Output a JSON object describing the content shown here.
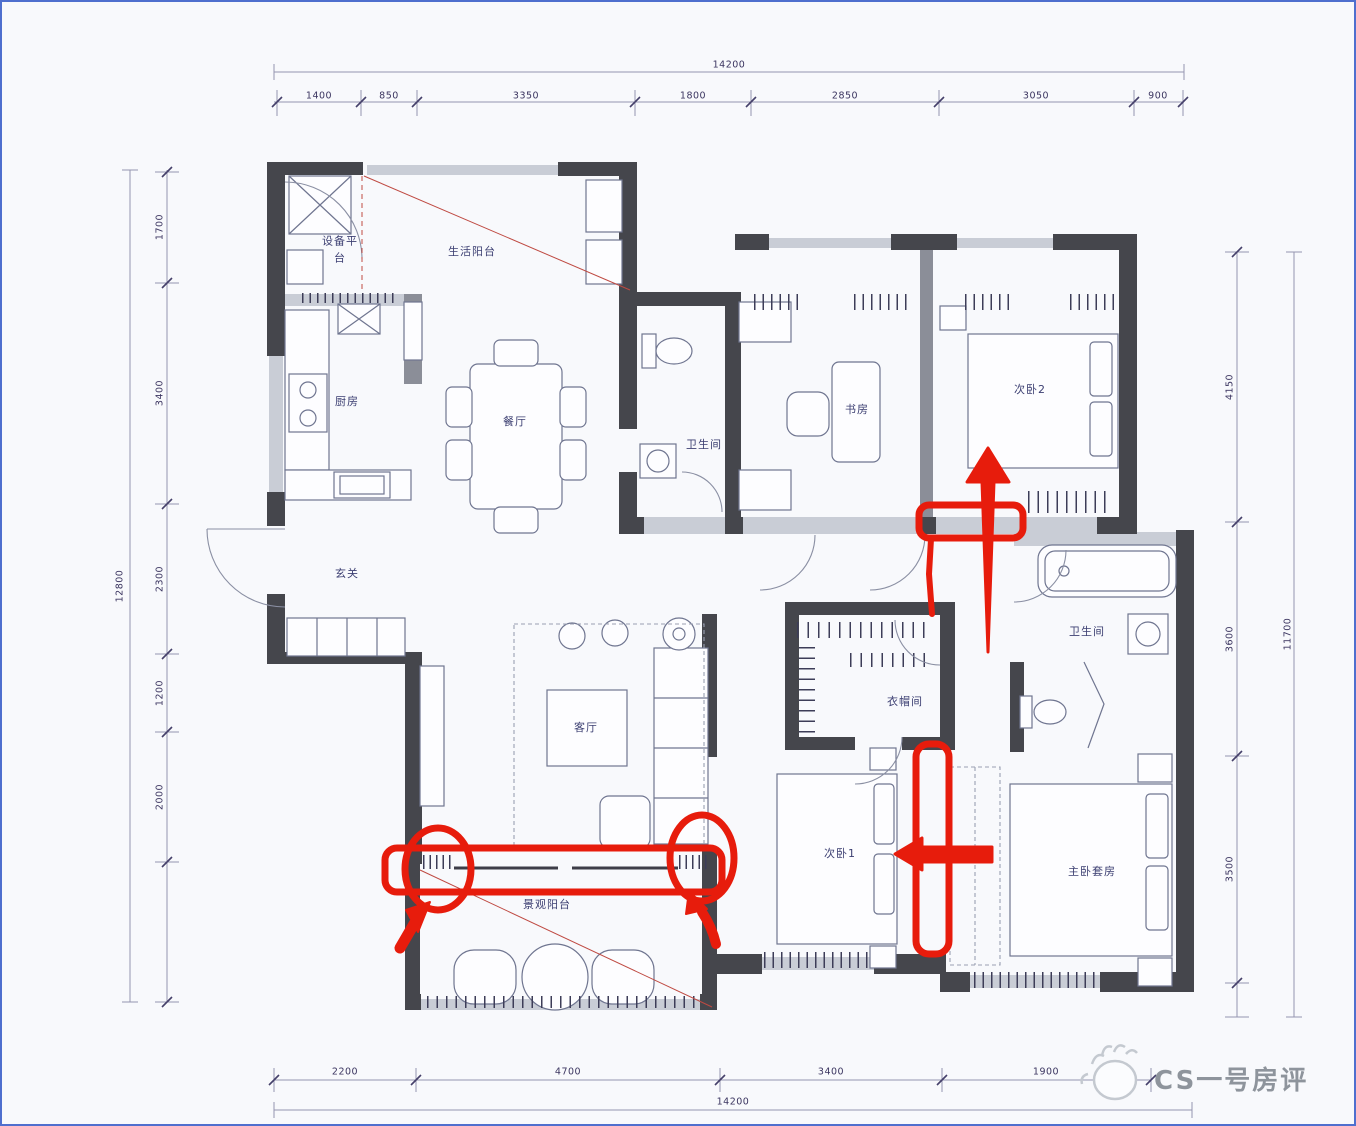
{
  "page": {
    "frame_color": "#4f6fce",
    "background": "#f8f9fc",
    "annotation_color": "#e71c0c",
    "wall_color": "#45464c"
  },
  "rooms": {
    "equipment_platform": {
      "label": "设备平台"
    },
    "life_balcony": {
      "label": "生活阳台"
    },
    "kitchen": {
      "label": "厨房"
    },
    "dining": {
      "label": "餐厅"
    },
    "bath_top": {
      "label": "卫生间"
    },
    "study": {
      "label": "书房"
    },
    "bedroom2": {
      "label": "次卧2"
    },
    "entry": {
      "label": "玄关"
    },
    "living": {
      "label": "客厅"
    },
    "cloakroom": {
      "label": "衣帽间"
    },
    "bath_master": {
      "label": "卫生间"
    },
    "bedroom1": {
      "label": "次卧1"
    },
    "master_suite": {
      "label": "主卧套房"
    },
    "view_balcony": {
      "label": "景观阳台"
    }
  },
  "dimensions": {
    "top": {
      "total": "14200",
      "segments": [
        "1400",
        "850",
        "3350",
        "1800",
        "2850",
        "3050",
        "900"
      ]
    },
    "bottom": {
      "total": "14200",
      "segments": [
        "2200",
        "4700",
        "3400",
        "1900"
      ]
    },
    "left": {
      "total": "12800",
      "segments": [
        "1700",
        "3400",
        "2300",
        "1200",
        "2000"
      ]
    },
    "right": {
      "total": "11700",
      "segments": [
        "4150",
        "3600",
        "3500"
      ]
    }
  },
  "annotations": {
    "color": "#e71c0c",
    "items": [
      "highlight-box-bedroom2-wall",
      "long-up-arrow",
      "red-connector-line",
      "highlight-box-balcony-doorwall",
      "circle-left-doorpost",
      "circle-right-doorpost",
      "small-arrow-left-doorpost",
      "small-arrow-right-doorpost",
      "highlight-box-bedroom1-wall",
      "big-left-arrow"
    ]
  },
  "watermark": {
    "text": "CS一号房评",
    "icon": "hand-logo-icon"
  }
}
